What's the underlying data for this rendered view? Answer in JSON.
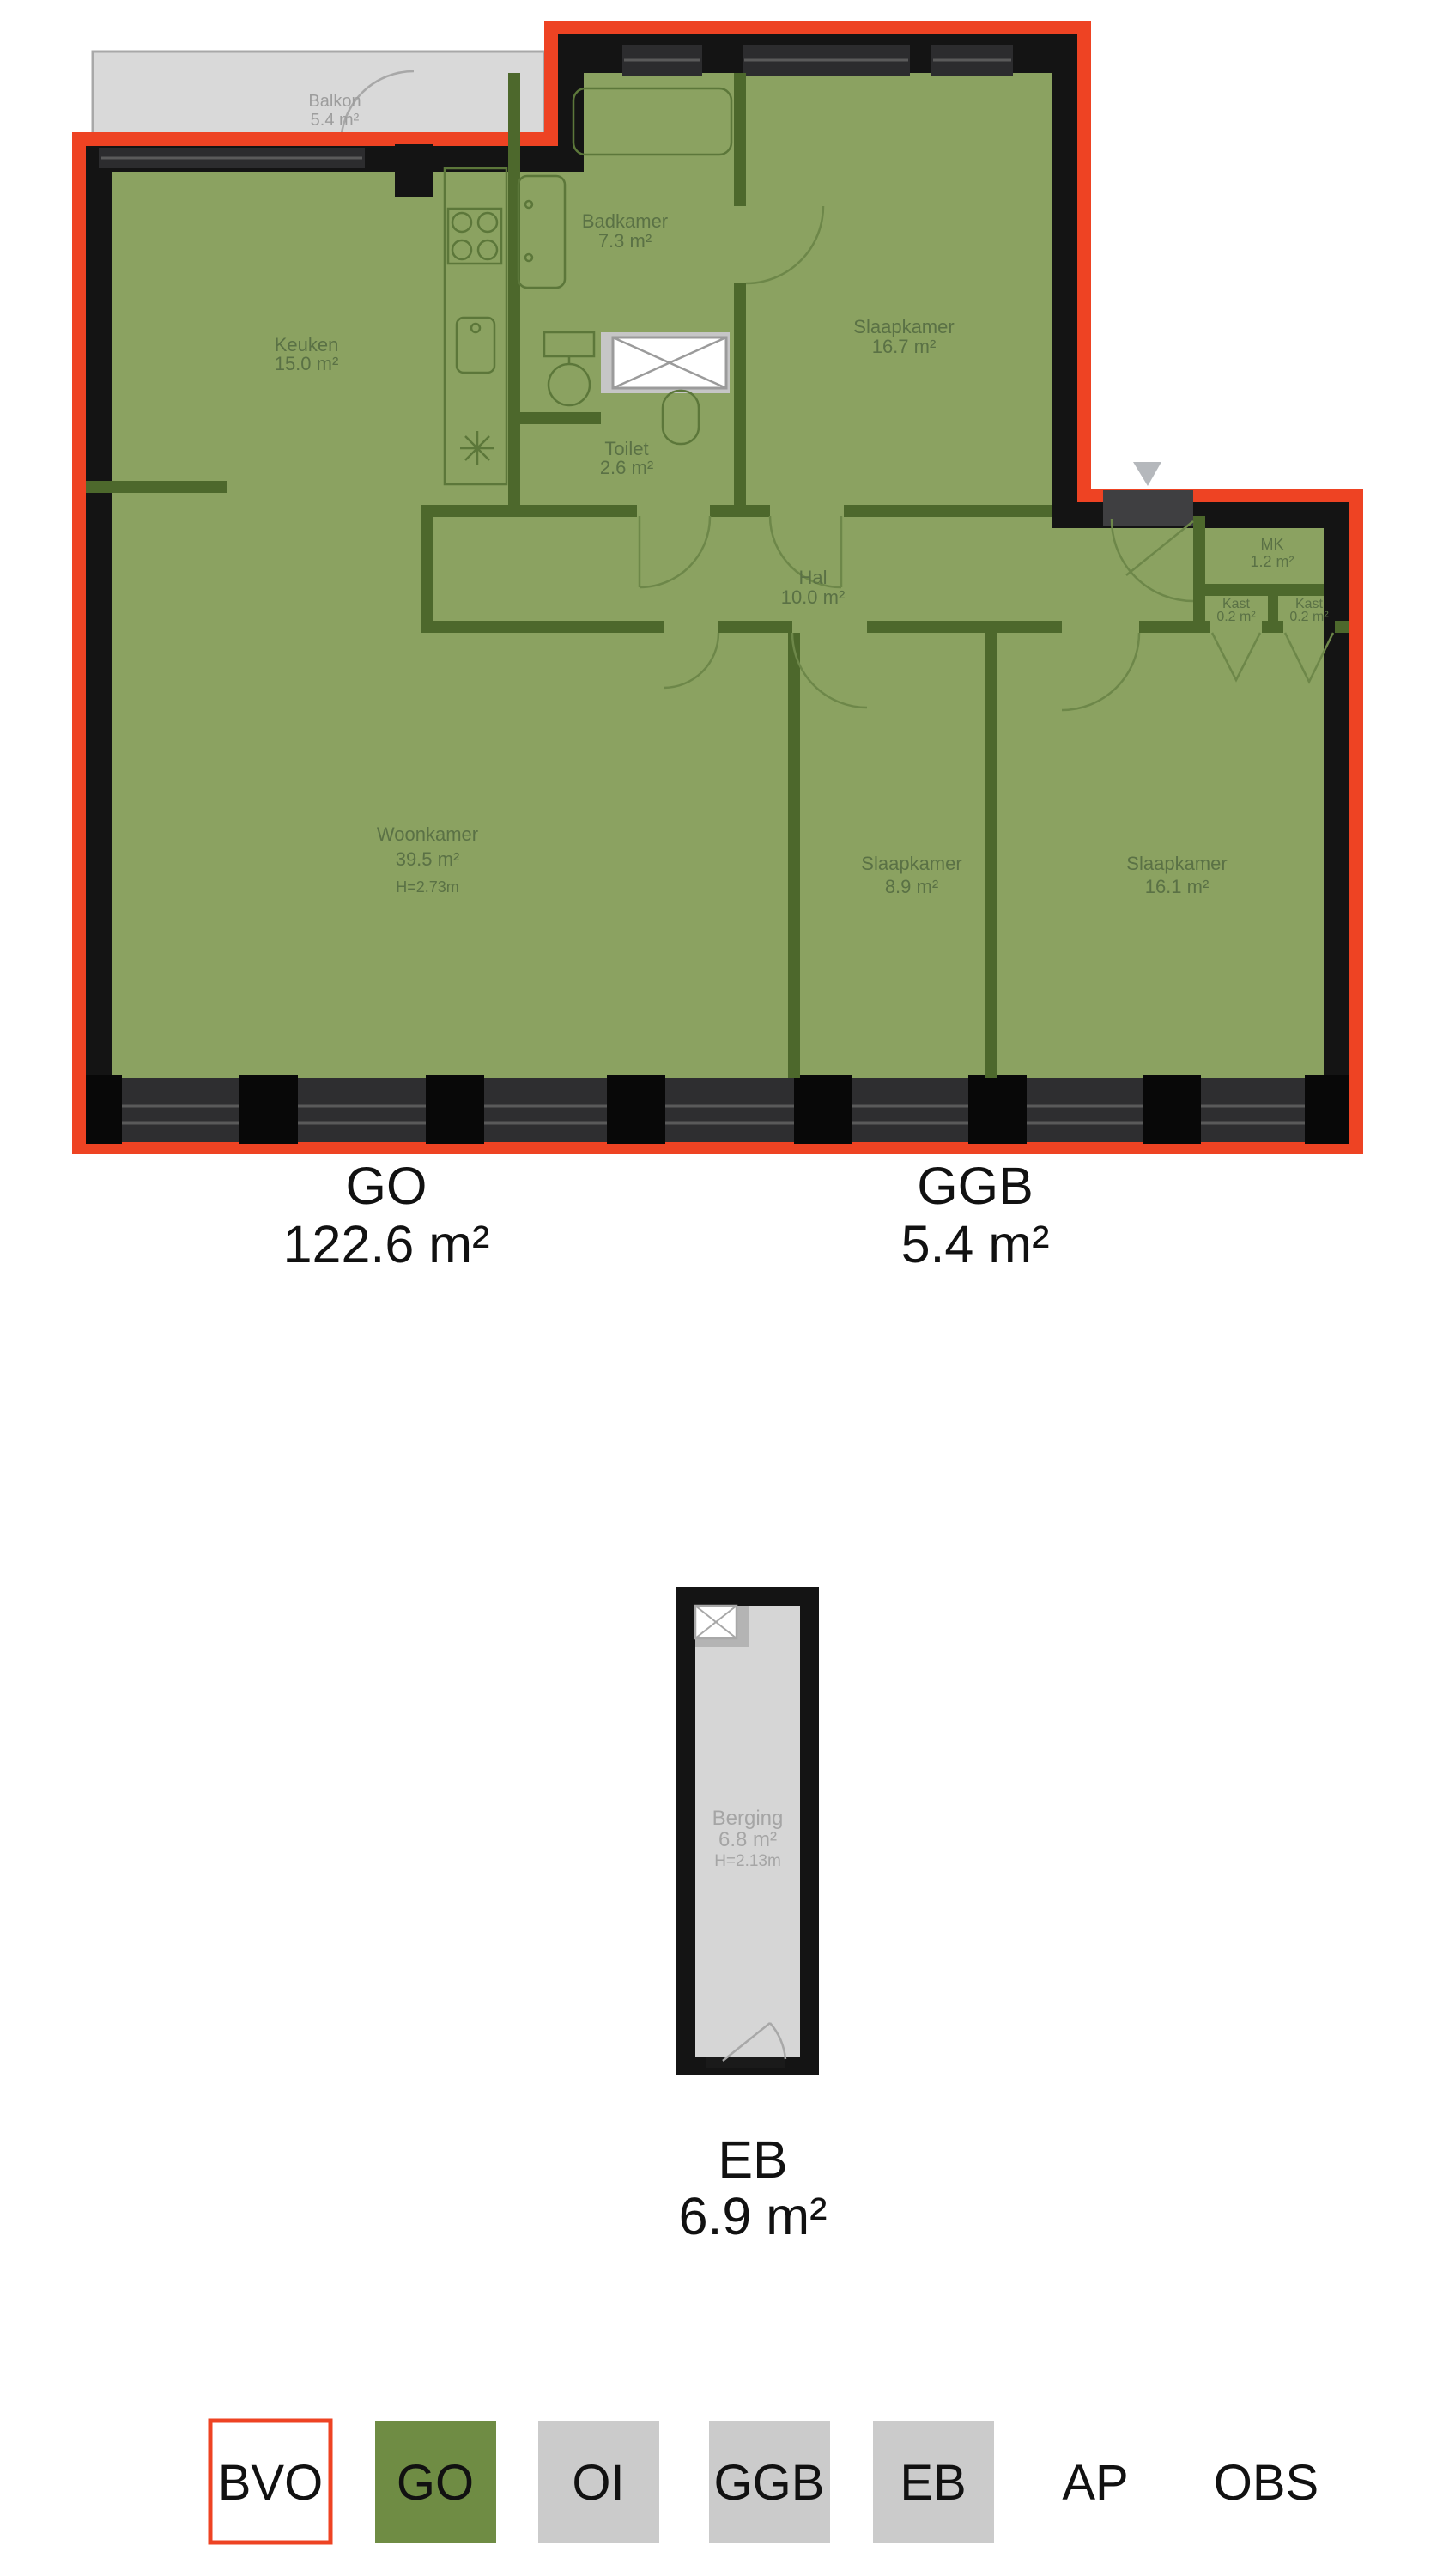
{
  "plan_main": {
    "rooms": {
      "balkon": {
        "name": "Balkon",
        "area": "5.4 m²"
      },
      "keuken": {
        "name": "Keuken",
        "area": "15.0 m²"
      },
      "badkamer": {
        "name": "Badkamer",
        "area": "7.3 m²"
      },
      "slaapkamer1": {
        "name": "Slaapkamer",
        "area": "16.7 m²"
      },
      "toilet": {
        "name": "Toilet",
        "area": "2.6 m²"
      },
      "hal": {
        "name": "Hal",
        "area": "10.0 m²"
      },
      "mk": {
        "name": "MK",
        "area": "1.2 m²"
      },
      "kast1": {
        "name": "Kast",
        "area": "0.2 m²"
      },
      "kast2": {
        "name": "Kast",
        "area": "0.2 m²"
      },
      "woonkamer": {
        "name": "Woonkamer",
        "area": "39.5 m²",
        "height": "H=2.73m"
      },
      "slaapkamer2": {
        "name": "Slaapkamer",
        "area": "8.9 m²"
      },
      "slaapkamer3": {
        "name": "Slaapkamer",
        "area": "16.1 m²"
      }
    },
    "totals": [
      {
        "code": "GO",
        "area": "122.6 m²"
      },
      {
        "code": "GGB",
        "area": "5.4 m²"
      }
    ]
  },
  "plan_storage": {
    "rooms": {
      "berging": {
        "name": "Berging",
        "area": "6.8 m²",
        "height": "H=2.13m"
      }
    },
    "totals": [
      {
        "code": "EB",
        "area": "6.9 m²"
      }
    ]
  },
  "legend": {
    "items": [
      {
        "label": "BVO",
        "style": "outline-red"
      },
      {
        "label": "GO",
        "style": "fill-green"
      },
      {
        "label": "OI",
        "style": "fill-gray"
      },
      {
        "label": "GGB",
        "style": "fill-gray"
      },
      {
        "label": "EB",
        "style": "fill-gray"
      },
      {
        "label": "AP",
        "style": "none"
      },
      {
        "label": "OBS",
        "style": "none"
      }
    ]
  },
  "colors": {
    "bvo_red": "#ee4323",
    "go_green": "#8ba261",
    "legend_green": "#6f8c44",
    "legend_gray": "#cbcbcb",
    "wall_black": "#141414",
    "storage_gray": "#d6d6d6"
  }
}
